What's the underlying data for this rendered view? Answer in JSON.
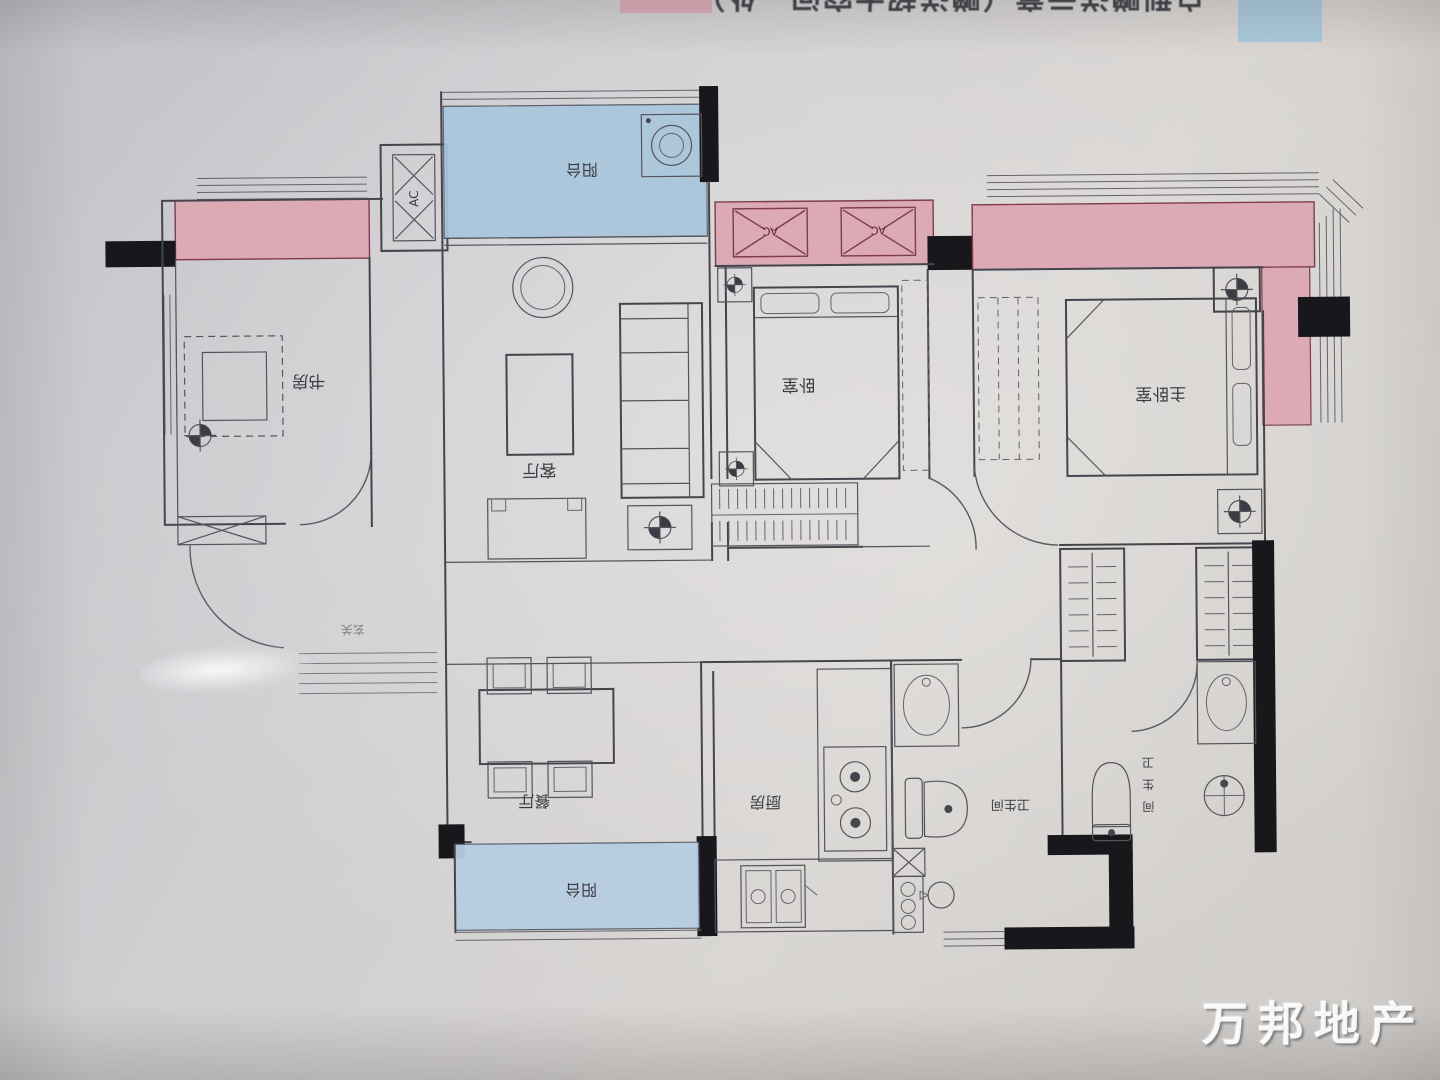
{
  "legend": {
    "clipped_text": "户型赠送示意（赠送超大空间—处）",
    "pink_color": "#dcaab5",
    "blue_color": "#a9c8dc"
  },
  "watermark": {
    "text": "万邦地产"
  },
  "plan": {
    "rooms": {
      "study": "书房",
      "balcony_top": "阳台",
      "living": "客厅",
      "bedroom": "卧室",
      "master_bedroom": "主卧室",
      "entry": "玄关",
      "dining": "餐厅",
      "kitchen": "厨房",
      "bathroom1": "卫生间",
      "bathroom2_chars": {
        "c0": "卫",
        "c1": "生",
        "c2": "间"
      },
      "balcony_bottom": "阳台"
    },
    "ac_label": "AC",
    "colors": {
      "pink": "#dcaab5",
      "pink_border": "#7e3c4c",
      "blue_top": "#a9c6dc",
      "blue_bottom": "#b7cde0",
      "line": "#45454d",
      "wall_black": "#17171c",
      "label_text": "#3b3b43"
    }
  }
}
